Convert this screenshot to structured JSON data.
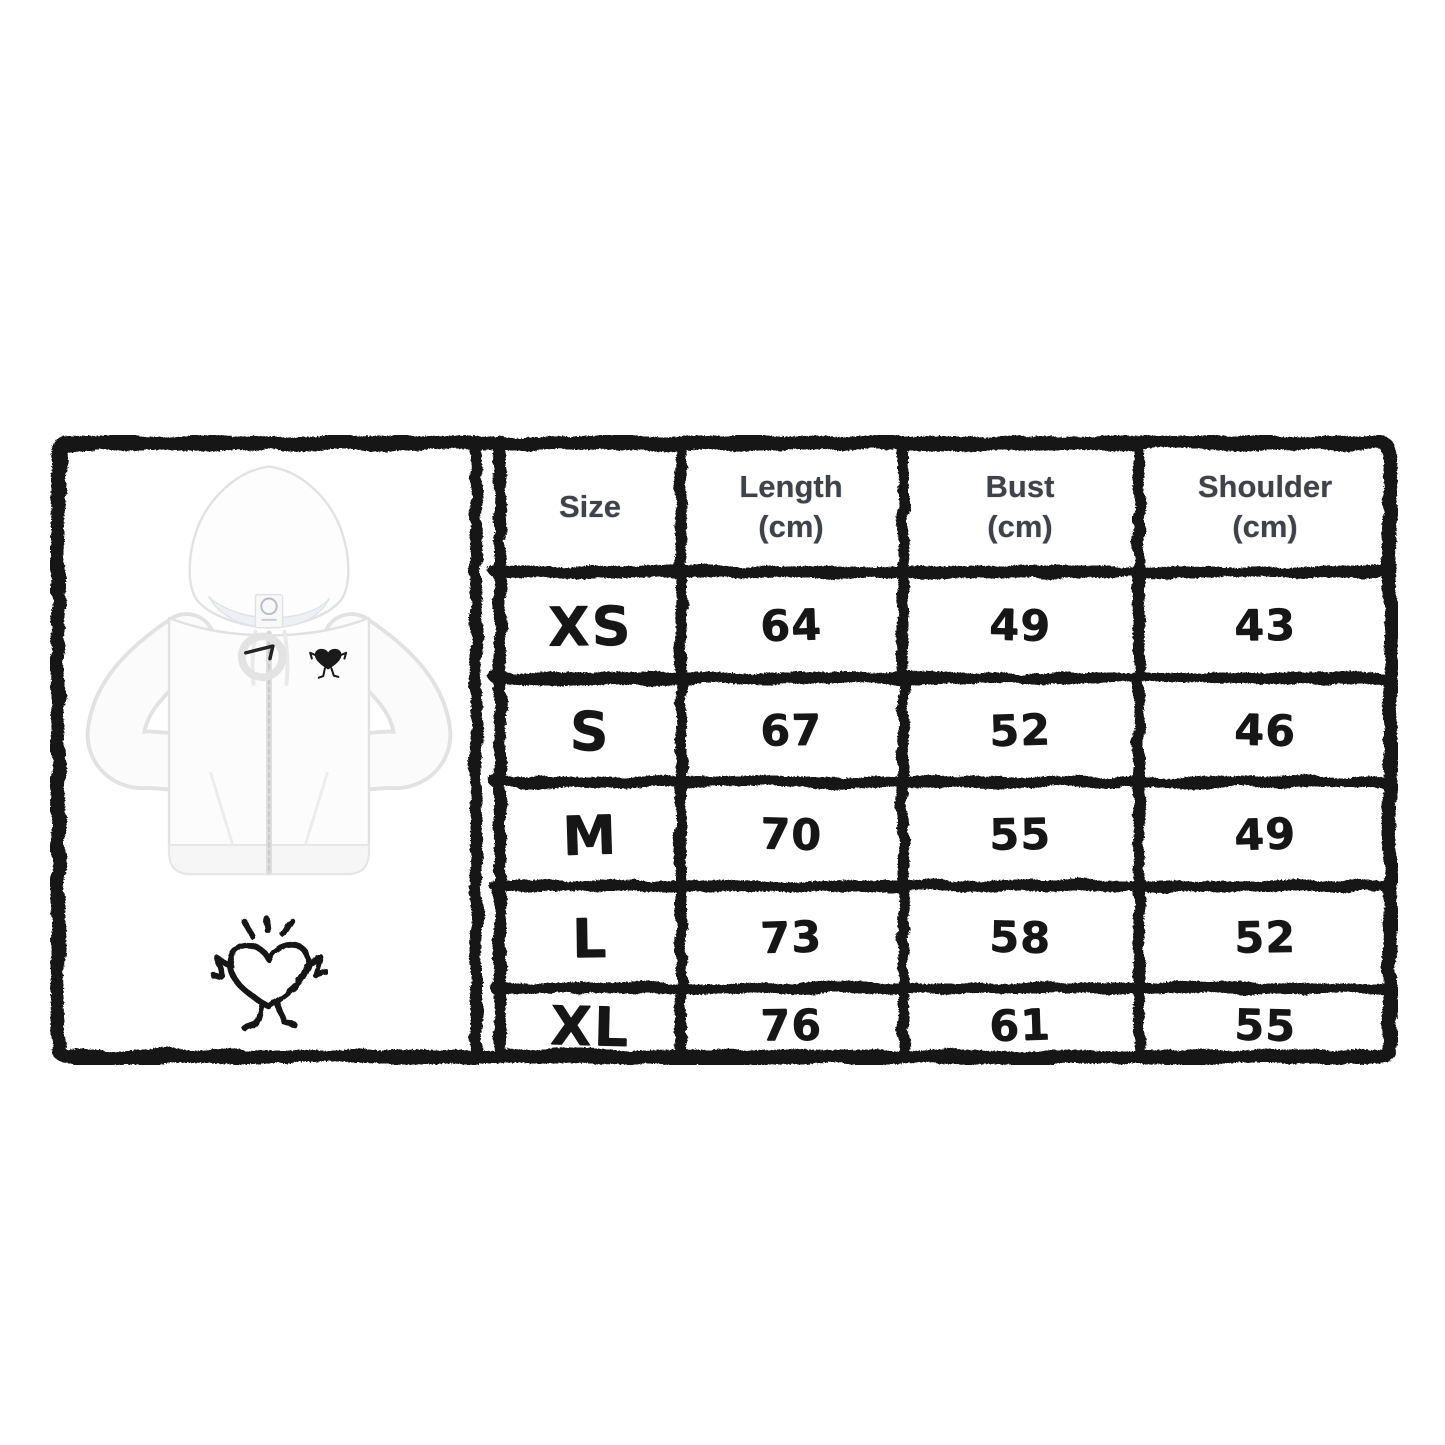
{
  "graphic": {
    "kind": "product-size-chart",
    "product": {
      "item": "white zip-up hoodie",
      "chest_logo": "black heart character with arms and legs",
      "doodle": "hand-drawn heart character with excitement rays"
    }
  },
  "size_chart": {
    "columns": [
      {
        "label": "Size",
        "unit": ""
      },
      {
        "label": "Length",
        "unit": "(cm)"
      },
      {
        "label": "Bust",
        "unit": "(cm)"
      },
      {
        "label": "Shoulder",
        "unit": "(cm)"
      }
    ],
    "rows": [
      {
        "size": "XS",
        "length": "64",
        "bust": "49",
        "shoulder": "43"
      },
      {
        "size": "S",
        "length": "67",
        "bust": "52",
        "shoulder": "46"
      },
      {
        "size": "M",
        "length": "70",
        "bust": "55",
        "shoulder": "49"
      },
      {
        "size": "L",
        "length": "73",
        "bust": "58",
        "shoulder": "52"
      },
      {
        "size": "XL",
        "length": "76",
        "bust": "61",
        "shoulder": "55"
      }
    ]
  },
  "chart_data": {
    "type": "table",
    "title": "Hoodie size chart",
    "columns": [
      "Size",
      "Length (cm)",
      "Bust (cm)",
      "Shoulder (cm)"
    ],
    "rows": [
      [
        "XS",
        64,
        49,
        43
      ],
      [
        "S",
        67,
        52,
        46
      ],
      [
        "M",
        70,
        55,
        49
      ],
      [
        "L",
        73,
        58,
        52
      ],
      [
        "XL",
        76,
        61,
        55
      ]
    ]
  },
  "colors": {
    "ink": "#141414",
    "header_text": "#40424a",
    "background": "#ffffff",
    "hoodie_outline": "#e2e2e2"
  }
}
